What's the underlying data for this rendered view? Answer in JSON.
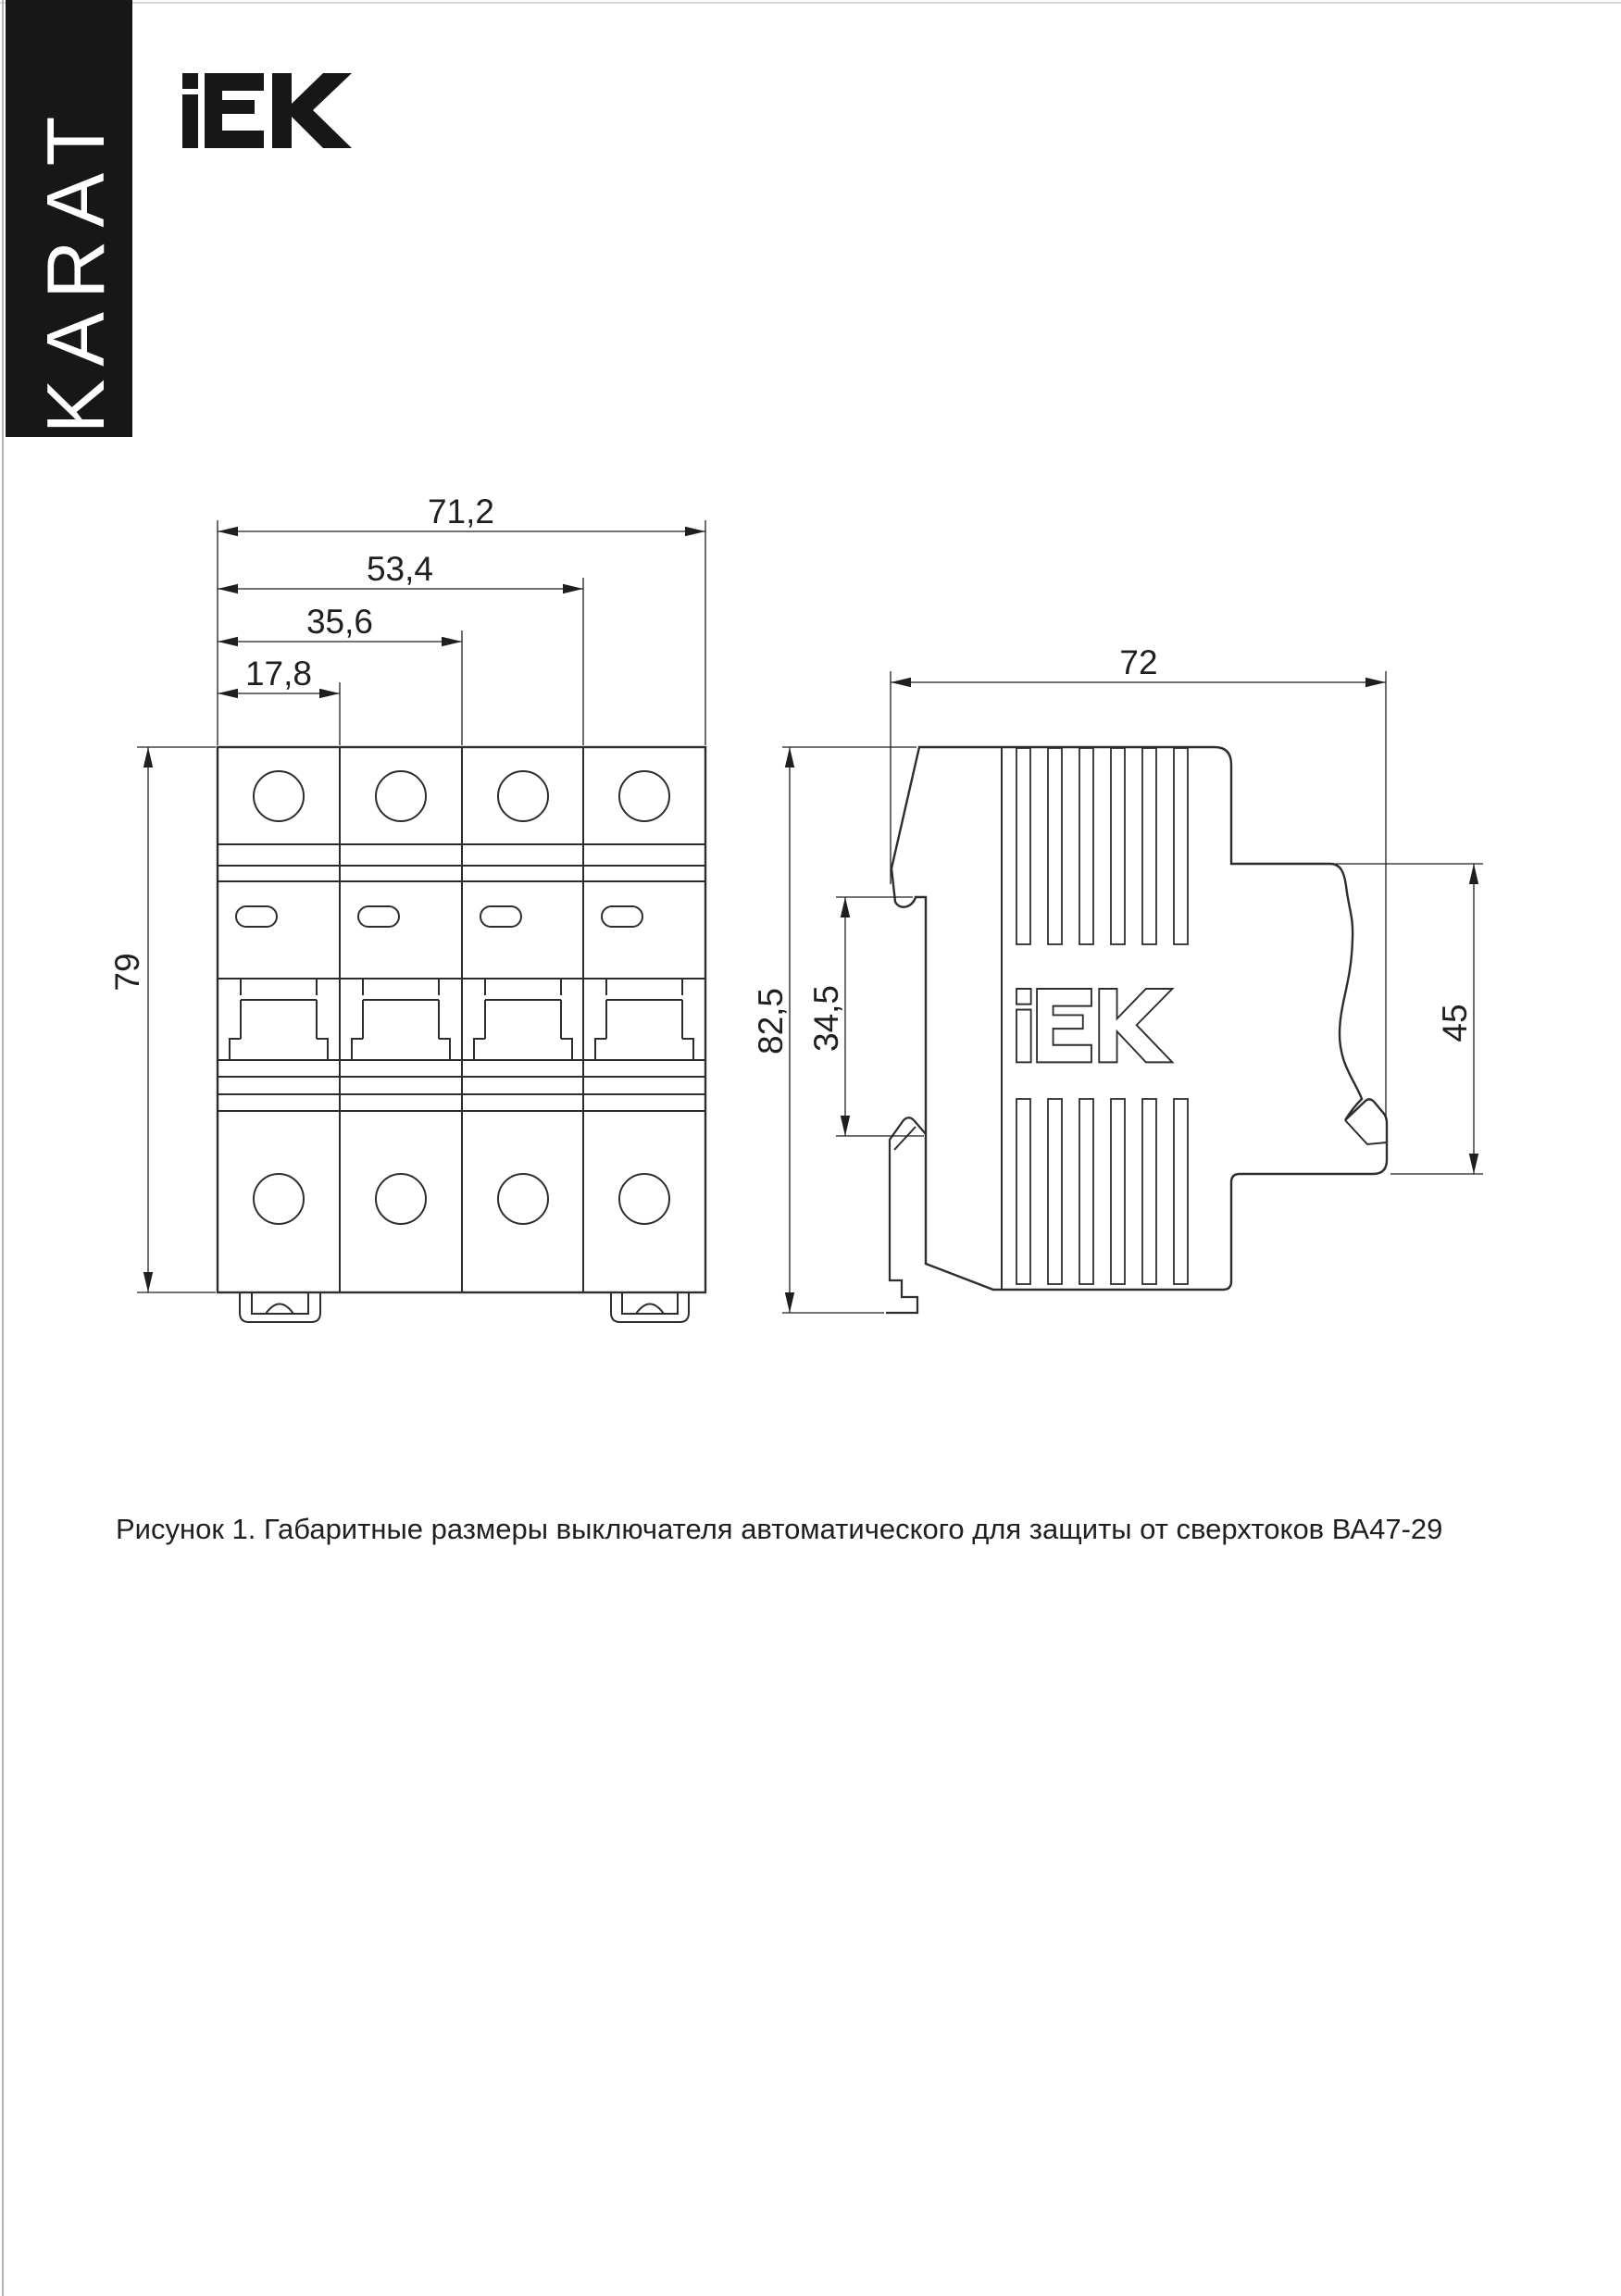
{
  "brand": {
    "karat_label": "KARAT",
    "iek_label": "IEK",
    "banner_color": "#171717"
  },
  "figure": {
    "caption": "Рисунок 1. Габаритные размеры выключателя автоматического для защиты от сверхтоков ВА47-29"
  },
  "front_view": {
    "name": "front view of 4-pole circuit breaker",
    "dims": {
      "width_total": "71,2",
      "width_three_modules": "53,4",
      "width_two_modules": "35,6",
      "width_one_module": "17,8",
      "height": "79"
    }
  },
  "side_view": {
    "name": "side view of circuit breaker",
    "logo": "iEK",
    "dims": {
      "depth_total": "72",
      "height_total": "82,5",
      "rail_channel": "34,5",
      "terminal_zone": "45"
    }
  },
  "colors": {
    "line": "#2d2d2d",
    "page_edge": "#9a9a9a"
  }
}
